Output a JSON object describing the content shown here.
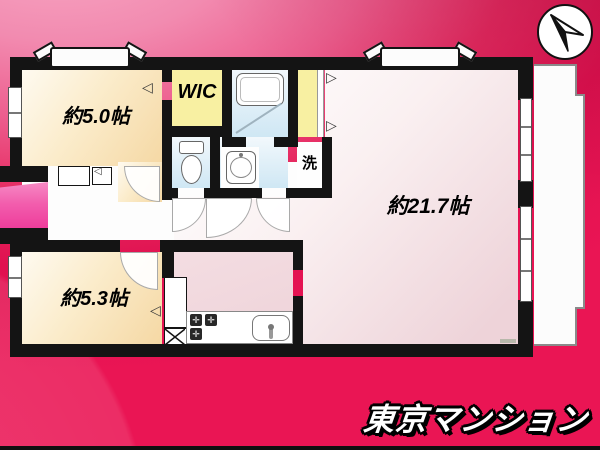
{
  "branding": {
    "logo": "東京マンション"
  },
  "floorplan": {
    "rooms": {
      "bedroom1": {
        "label": "約5.0帖"
      },
      "bedroom2": {
        "label": "約5.3帖"
      },
      "living": {
        "label": "約21.7帖"
      },
      "wic": {
        "label": "WIC"
      },
      "laundry": {
        "label": "洗"
      }
    },
    "icons": {
      "compass": "north-arrow",
      "fold_left": "◁",
      "fold_right": "▷",
      "burner_mark": "✛"
    },
    "colors": {
      "wall": "#141414",
      "room_cream": "#f5d8a4",
      "closet_yellow": "#f8f0a2",
      "wet_blue": "#cfe7f4",
      "living_pink": "#eed3d9",
      "entrance_pink": "#ee3d9b",
      "background_top": "#f7a9c5",
      "background_bottom": "#e01150",
      "logo_text_color": "#ffffff"
    }
  }
}
